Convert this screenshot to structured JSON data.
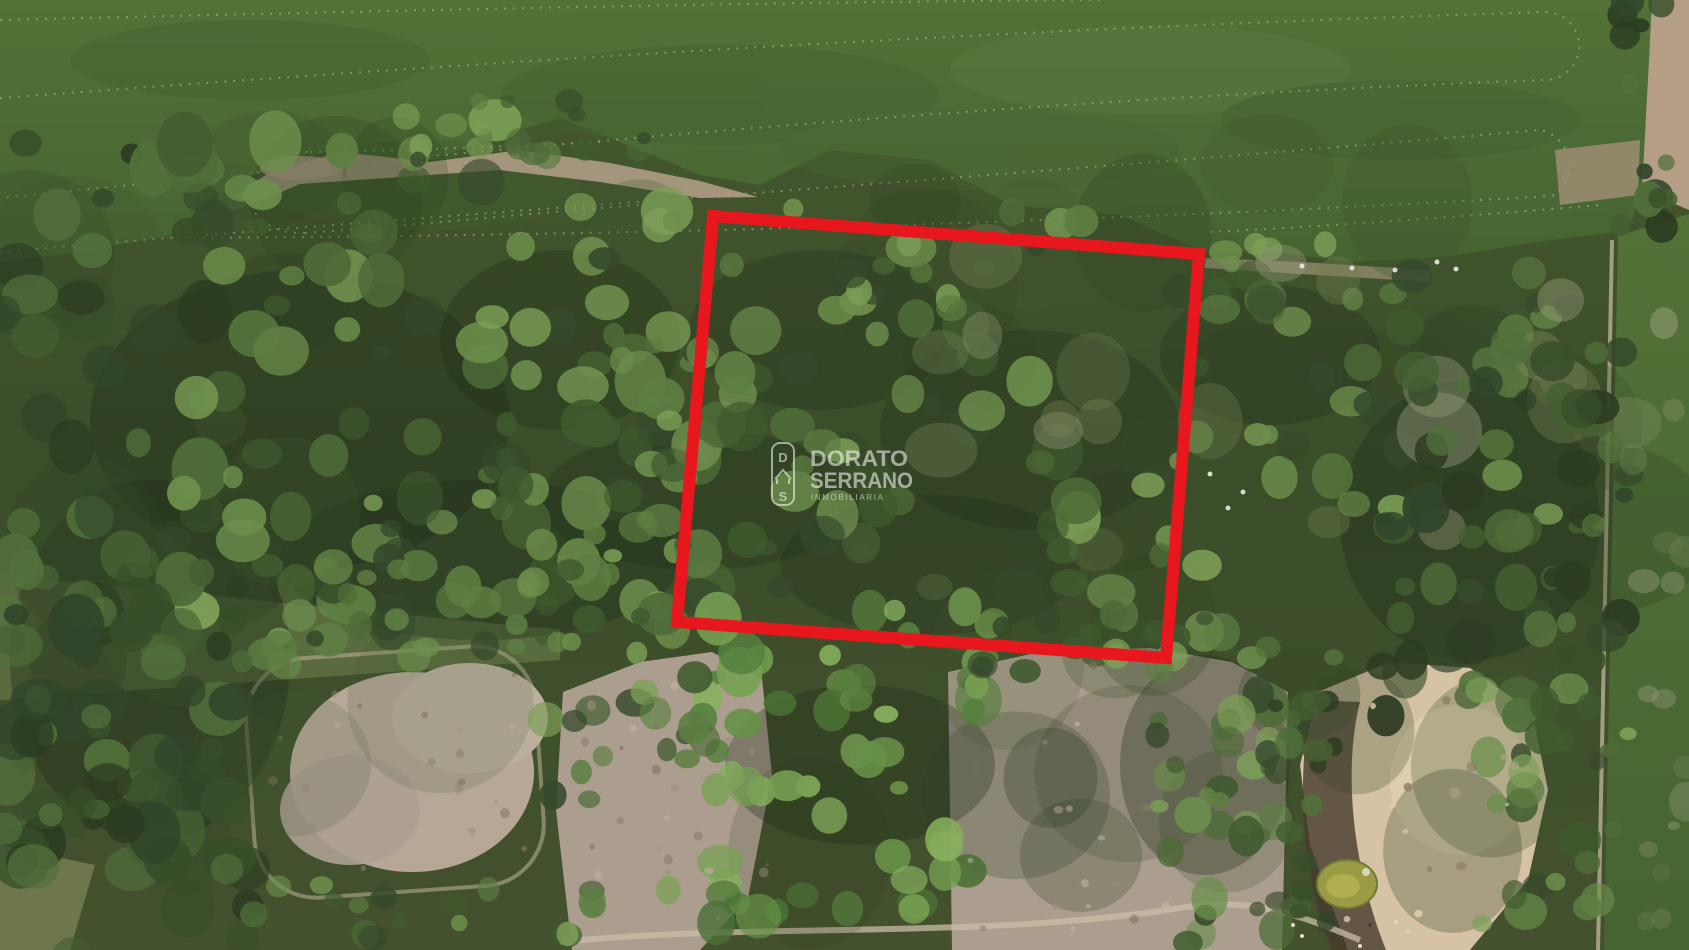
{
  "watermark": {
    "brand_line1": "DORATO",
    "brand_line2": "SERRANO",
    "tagline": "INMOBILIARIA",
    "logo_top_letter": "D",
    "logo_bottom_letter": "S",
    "text_color": "#ffffff"
  },
  "boundary": {
    "color": "#e8161d",
    "stroke_width": "12",
    "points": "713,216 1199,254 1166,658 677,622"
  },
  "palette": {
    "crop_field_green": "#4f6e39",
    "woodland_green": "#3c4f2c",
    "canopy_light_green": "#7da057",
    "pasture_tan": "#ab9e8e",
    "sand_pit": "#d6c2a4",
    "pond_yellow_green": "#9a9b44",
    "bare_strip_pink": "#b5a18c"
  }
}
